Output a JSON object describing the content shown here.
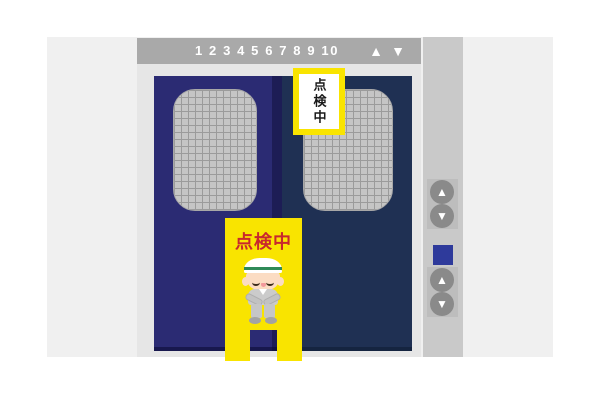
{
  "indicator": {
    "floor_numbers": "1 2 3 4 5 6 7 8 9 10",
    "up_icon": "▲",
    "down_icon": "▼"
  },
  "door_sign": {
    "text": "点検中"
  },
  "floor_stand_sign": {
    "text": "点検中"
  },
  "call_panel": {
    "top_up_icon": "▲",
    "top_down_icon": "▼",
    "bottom_up_icon": "▲",
    "bottom_down_icon": "▼"
  },
  "colors": {
    "wall": "#F0F0F0",
    "frame": "#E6E6E6",
    "indicator_bar": "#A9A9A9",
    "left_door": "#2B2B73",
    "right_door": "#1F3053",
    "door_gap": "#1D1D55",
    "window_mesh": "#C5C5C5",
    "sign_yellow": "#F9E400",
    "sign_red_text": "#C8282D",
    "sign_black_text": "#1A1A1A",
    "call_strip": "#C9C9C9",
    "button_circle": "#8A8A8A",
    "position_light_blue": "#2E3A9B",
    "helmet_stripe_green": "#2F8A57"
  }
}
